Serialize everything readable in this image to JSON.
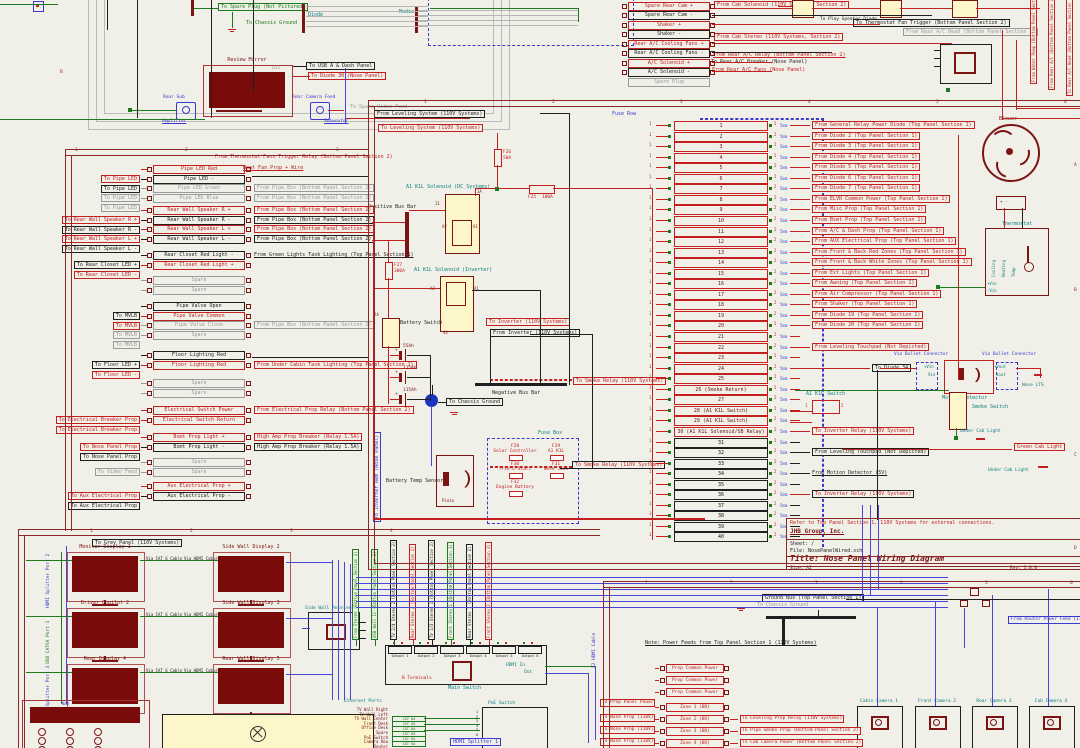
{
  "meta": {
    "title": "Nose Panel Wiring Diagram"
  },
  "colors": {
    "background": "#f0efe8",
    "wire_red": "#c42020",
    "wire_green": "#1d7a1d",
    "wire_blue": "#4646d8",
    "component_dark_red": "#7c1414",
    "component_yellow": "#fdf6c8",
    "teal": "#0e8080",
    "sheet_border": "#8b2727"
  },
  "rulers": {
    "main": [
      "1",
      "2",
      "3",
      "4",
      "5",
      "6"
    ],
    "left": [
      "1",
      "2",
      "3"
    ],
    "bottom_left": [
      "1",
      "2",
      "3",
      "4"
    ],
    "bottom_right": [
      "1",
      "2",
      "3",
      "4",
      "5",
      "6"
    ],
    "letters": [
      "A",
      "B",
      "C",
      "D"
    ]
  },
  "top_left": {
    "spare_plug": "To Spare Plug (Not Pictured)",
    "chassis_ground": "To Chassis Ground",
    "diode": "Diode",
    "media": "Media",
    "conn1_top": "Rear Sub",
    "conn1_bot": "Amplifier",
    "conn2_top": "Rear Camera Feed",
    "conn2_bot": "Subwoofer",
    "monitor_label": "Review Mirror",
    "monitor_ref": "U12",
    "usb_label": "To USB A & Dash Panel",
    "diode30": "To Diode 30 (Nose Panel)",
    "spare_video": "To Spare Video Feed",
    "row_letter": "B"
  },
  "top_pairs": {
    "rows": [
      {
        "a": "Spare Rear Cam +",
        "b": "Spare Rear Cam -"
      },
      {
        "a": "Shaker +",
        "b": "Shaker -"
      },
      {
        "a": "Rear A/C Cooling Fans +",
        "b": "Rear A/C Cooling Fans -"
      },
      {
        "a": "A/C Solenoid +",
        "b": "A/C Solenoid -"
      }
    ],
    "spare": "Spare Plug",
    "lab_play": "To Play Speaker Diode",
    "lab_cab_solenoid": "From Cab Solenoid (110V Systems, Section 2)",
    "lab_cab_stereo": "From Cab Stereo (110V Systems, Section 2)",
    "lab_thermo": "To Thermostat Fan Trigger (Bottom Panel Section 2)",
    "lab_ac_head": "From Rear A/C Head (Bottom Panel Section 2)",
    "lab_ac_relay": "From Rear A/C Relay (Bottom Panel Section 2)",
    "lab_ac_breaker": "To Rear A/C Breaker (Nose Panel)",
    "lab_ac_fans": "From Rear A/C Fans (Nose Panel)",
    "vlabels": [
      "From Water Pump (Bottom Panel Section 2)",
      "From Rear A/C (Bottom Panel Section 2)",
      "To Rear A/C Head (Bottom Panel Section 2)"
    ]
  },
  "left_sheet": {
    "note1": "From Thermostat Fans Trigger Relay (Bottom Panel Section 2)",
    "note2": "Heat Fan Prop + Wire",
    "pin1": "1",
    "pin2": "2",
    "groups": [
      {
        "rows": [
          {
            "l": "To Pipe LED",
            "c": "Pipe LED Red",
            "r": "",
            "cls": "red"
          },
          {
            "l": "To Pipe LED",
            "c": "Pipe LED -",
            "r": "",
            "cls": "black"
          },
          {
            "l": "To Pipe LED",
            "c": "Pipe LED Green",
            "r": "From Pipe Box (Bottom Panel Section 2)",
            "cls": "gray"
          },
          {
            "l": "To Pipe LED",
            "c": "Pipe LED Blue",
            "r": "From Pipe Box (Bottom Panel Section 2)",
            "cls": "gray"
          }
        ]
      },
      {
        "rows": [
          {
            "l": "To Rear Wall Speaker R +",
            "c": "Rear Wall Speaker R +",
            "r": "From Pipe Box (Bottom Panel Section 2)",
            "cls": "red"
          },
          {
            "l": "To Rear Wall Speaker R -",
            "c": "Rear Wall Speaker R -",
            "r": "From Pipe Box (Bottom Panel Section 2)",
            "cls": "black"
          },
          {
            "l": "To Rear Wall Speaker L +",
            "c": "Rear Wall Speaker L +",
            "r": "From Pipe Box (Bottom Panel Section 2)",
            "cls": "red"
          },
          {
            "l": "To Rear Wall Speaker L -",
            "c": "Rear Wall Speaker L -",
            "r": "From Pipe Box (Bottom Panel Section 2)",
            "cls": "black"
          }
        ]
      },
      {
        "rows": [
          {
            "l": "To Rear Closet LED +",
            "c": "Rear Closet Red Light -",
            "r": "From Green Lights Task Lighting (Top Panel Section 1)",
            "cls": "black",
            "rp": true
          },
          {
            "l": "To Rear Closet LED -",
            "c": "Rear Closet Red Light +",
            "r": "",
            "cls": "red"
          }
        ]
      },
      {
        "rows": [
          {
            "l": "",
            "c": "Spare",
            "r": "",
            "cls": "gray"
          },
          {
            "l": "",
            "c": "Spare",
            "r": "",
            "cls": "gray"
          }
        ]
      },
      {
        "rows": [
          {
            "l": "To MVLB",
            "c": "Pipe Valve Open",
            "r": "",
            "cls": "black"
          },
          {
            "l": "To MVLB",
            "c": "Pipe Valve Common",
            "r": "",
            "cls": "red"
          },
          {
            "l": "To MVLB",
            "c": "Pipe Valve Close",
            "r": "From Pipe Box (Bottom Panel Section 2)",
            "cls": "gray"
          },
          {
            "l": "To MVLB",
            "c": "Spare",
            "r": "",
            "cls": "gray"
          }
        ]
      },
      {
        "rows": [
          {
            "l": "To Floor LED +",
            "c": "Floor Lighting Red",
            "r": "",
            "cls": "black"
          },
          {
            "l": "To Floor LED -",
            "c": "Floor Lighting Red",
            "r": "From Under Cabin Task Lighting (Top Panel Section 1)",
            "cls": "red"
          }
        ]
      },
      {
        "rows": [
          {
            "l": "",
            "c": "Spare",
            "r": "",
            "cls": "gray"
          },
          {
            "l": "",
            "c": "Spare",
            "r": "",
            "cls": "gray"
          }
        ]
      },
      {
        "rows": [
          {
            "l": "To Electrical Breaker Prop",
            "c": "Electrical Switch Power",
            "r": "From Electrical Prop Relay (Bottom Panel Section 2)",
            "cls": "red"
          },
          {
            "l": "To Electrical Breaker Prop",
            "c": "Electrical Switch Return",
            "r": "",
            "cls": "red"
          }
        ]
      },
      {
        "rows": [
          {
            "l": "To Nose Panel Prop",
            "c": "Bsmt Prop Light +",
            "r": "High Amp Prop Breaker (Relay 1.5A)",
            "cls": "red"
          },
          {
            "l": "To Nose Panel Prop",
            "c": "Bsmt Prop Light -",
            "r": "High Amp Prop Breaker (Relay 1.5A)",
            "cls": "black"
          }
        ]
      },
      {
        "rows": [
          {
            "l": "To Video Feed",
            "c": "Spare",
            "r": "",
            "cls": "gray"
          },
          {
            "l": "",
            "c": "Spare",
            "r": "",
            "cls": "gray"
          }
        ]
      },
      {
        "rows": [
          {
            "l": "To Aux Electrical Prop",
            "c": "Aux Electrical Prop +",
            "r": "",
            "cls": "red"
          },
          {
            "l": "To Aux Electrical Prop",
            "c": "Aux Electrical Prop -",
            "r": "",
            "cls": "black"
          }
        ]
      }
    ]
  },
  "power": {
    "from_leveling": "From Leveling System (110V Systems)",
    "to_leveling": "To Leveling System (110V Systems)",
    "f26": "F26",
    "f26a": "50A",
    "f25": "F25",
    "f25a": "100A",
    "sol_dc": "A1 K1L Solenoid (DC Systems)",
    "sol_inv": "A1 K1L Solenoid (Inverter)",
    "pos_bus": "Positive Bus Bar",
    "neg_bus": "Negative Bus Bar",
    "f27": "F27",
    "f27a": "300A",
    "bat_switch": "Battery Switch",
    "bats": [
      "55Ah",
      "115Ah",
      "115Ah"
    ],
    "plus": "+",
    "to_chassis": "To Chassis Ground",
    "to_inverter": "To Inverter (110V Systems)",
    "from_inverter": "From Inverter (110V Systems)",
    "fuse_box": "Fuse Box",
    "fuses": [
      {
        "n": "F28",
        "l": "Solar Controller"
      },
      {
        "n": "F29",
        "l": "A1 K1L"
      },
      {
        "n": "F30",
        "l": "Trik-L-Start"
      },
      {
        "n": "F31",
        "l": "Nose Jack"
      },
      {
        "n": "F32",
        "l": "Engine Battery"
      }
    ],
    "bts": "Battery Temp Sensor",
    "piezo": "Piezo",
    "smoke1": "To Smoke Relay (110V Systems)",
    "smoke2": "To Smoke Relay (110V Systems)",
    "inv_rem": "To Inverter Rem (Nose Panel)",
    "p1a": "1A",
    "p11": "11",
    "pa2": "A2",
    "pa1": "A1",
    "p44": "44",
    "p24": "24"
  },
  "fuse_row": {
    "title": "Fuse Row",
    "pin1": "1",
    "pin2": "2",
    "gauge": "5mm",
    "rows": [
      {
        "n": "1",
        "label": "From General Relay Power Diode (Top Panel Section 1)",
        "t": "rb"
      },
      {
        "n": "2",
        "label": "From Diode 2 (Top Panel Section 1)",
        "t": "rb"
      },
      {
        "n": "3",
        "label": "From Diode 3 (Top Panel Section 1)",
        "t": "rb"
      },
      {
        "n": "4",
        "label": "From Diode 4 (Top Panel Section 1)",
        "t": "rb"
      },
      {
        "n": "5",
        "label": "From Diode 5 (Top Panel Section 1)",
        "t": "rb"
      },
      {
        "n": "6",
        "label": "From Diode 6 (Top Panel Section 1)",
        "t": "rb"
      },
      {
        "n": "7",
        "label": "From Diode 7 (Top Panel Section 1)",
        "t": "rb"
      },
      {
        "n": "8",
        "label": "From ELVR Common Power (Top Panel Section 1)",
        "t": "rb"
      },
      {
        "n": "9",
        "label": "From Misc Prop (Top Panel Section 1)",
        "t": "rb"
      },
      {
        "n": "10",
        "label": "From Bsmt Prop (Top Panel Section 1)",
        "t": "rb"
      },
      {
        "n": "11",
        "label": "From A/C & Dash Prop (Top Panel Section 1)",
        "t": "rb"
      },
      {
        "n": "12",
        "label": "From AUX Electrical Prop (Top Panel Section 1)",
        "t": "rb"
      },
      {
        "n": "13",
        "label": "From Front & Back Red Zones (Top Panel Section 1)",
        "t": "rb"
      },
      {
        "n": "14",
        "label": "From Front & Back White Zones (Top Panel Section 1)",
        "t": "rb"
      },
      {
        "n": "15",
        "label": "From Ext Lights (Top Panel Section 1)",
        "t": "rb"
      },
      {
        "n": "16",
        "label": "From Awning (Top Panel Section 1)",
        "t": "rb"
      },
      {
        "n": "17",
        "label": "From Air Compressor (Top Panel Section 1)",
        "t": "rb"
      },
      {
        "n": "18",
        "label": "From Shaker (Top Panel Section 1)",
        "t": "rb"
      },
      {
        "n": "19",
        "label": "From Diode 19 (Top Panel Section 1)",
        "t": "rb"
      },
      {
        "n": "20",
        "label": "From Diode 20 (Top Panel Section 1)",
        "t": "rb"
      },
      {
        "n": "21",
        "label": "",
        "t": ""
      },
      {
        "n": "22",
        "label": "From Leveling Touchpad (Not Depicted)",
        "t": "rb"
      },
      {
        "n": "23",
        "label": "",
        "t": ""
      },
      {
        "n": "24",
        "label": "To Diode 34",
        "t": "d34"
      },
      {
        "n": "25",
        "label": "",
        "t": ""
      },
      {
        "n": "26 (Smoke Return)",
        "label": "",
        "t": ""
      },
      {
        "n": "27",
        "label": "",
        "t": ""
      },
      {
        "n": "28 (A1 K1L Switch)",
        "label": "",
        "t": ""
      },
      {
        "n": "29 (A1 K1L Switch)",
        "label": "",
        "t": ""
      },
      {
        "n": "30 (A1 K1L Solenoid/SB Relay)",
        "label": "To Inverter Relay (110V Systems)",
        "t": "rb"
      },
      {
        "n": "31",
        "label": "",
        "t": ""
      },
      {
        "n": "32",
        "label": "From Leveling Touchpad (Not Depicted)",
        "t": "kb"
      },
      {
        "n": "33",
        "label": "",
        "t": ""
      },
      {
        "n": "34",
        "label": "From Motion Detector (5V)",
        "t": "kt"
      },
      {
        "n": "35",
        "label": "",
        "t": ""
      },
      {
        "n": "36",
        "label": "To Inverter Relay (110V Systems)",
        "t": "rk"
      },
      {
        "n": "37",
        "label": "",
        "t": ""
      },
      {
        "n": "38",
        "label": "",
        "t": ""
      },
      {
        "n": "39",
        "label": "",
        "t": ""
      },
      {
        "n": "40",
        "label": "",
        "t": ""
      }
    ]
  },
  "right_side": {
    "blower": "Blower",
    "blower_pins": "+   -",
    "thermostat": "Thermostat",
    "t_cool": "Cooling",
    "t_heat": "Heating",
    "t_temp": "Temp",
    "t_vin1": "+Vin",
    "t_vin2": "-Vin",
    "bullet1": "Via Bullet Connector",
    "bullet2": "Via Bullet Connector",
    "motion": "Motion Detector",
    "m_vin1": "+Vin",
    "m_vin2": "Vin",
    "m_vout1": "+Vout",
    "m_vout2": "Vout",
    "nose_lts": "Nose LTS",
    "smoke_switch": "Smoke Switch",
    "a1k1l": "A1 K1L Switch",
    "sw_p1": "1",
    "sw_p2": "2",
    "under1": "Under Cab Light",
    "under2": "Under Cab Light",
    "green_cab": "Green Cab Light"
  },
  "title_block": {
    "note": "Refer to Top Panel Section 1, 110V Systems for external connections.",
    "company": "JHB Group, Inc.",
    "sheet": "Sheet: /",
    "file": "File: NosePanelWired.sch",
    "title": "Title: Nose Panel Wiring Diagram",
    "size": "Size: A2",
    "rev": "Rev: 1.0.0"
  },
  "grey_panel": {
    "header": "To Grey Panel (110V Systems)",
    "monitors": [
      "Monitor Display 1",
      "Side Wall Display 2",
      "Driver Copilot 2",
      "Side Wall Display 3",
      "Rear Display 4",
      "Rear Wall Display 5"
    ],
    "via1": "Via CAT 6 Cable",
    "via2": "Via HDMI Cable",
    "side_labels": [
      {
        "t": "HDMI Splitter Port 2",
        "c": "b"
      },
      {
        "t": "USB CAT6A Port 1",
        "c": "g"
      },
      {
        "t": "HDMI Splitter Port 3",
        "c": "b"
      }
    ],
    "receiver": "Side Wall Receiver",
    "touchpad": "Nav"
  },
  "av": {
    "vlabels": [
      {
        "t": "From Stereo (Bottom Panel Section 2)",
        "c": "g"
      },
      {
        "t": "USB Wall In (Bottom Panel Section 2)",
        "c": "g"
      },
      {
        "t": "TV 2/4 Stereo 2 (Bottom Panel Section 2)",
        "c": "k"
      },
      {
        "t": "Rear Stereo 2 (Bottom Panel Section 2)",
        "c": "r"
      },
      {
        "t": "TV 1/3 Stereo 1 (Bottom Panel Section 2)",
        "c": "k"
      },
      {
        "t": "Front Stereo 1 (Bottom Panel Section 2)",
        "c": "g"
      },
      {
        "t": "Rear Stereo 1 (Bottom Panel Section 2)",
        "c": "k"
      },
      {
        "t": "Front Stereo 2 (Bottom Panel Section 2)",
        "c": "r"
      }
    ],
    "main_switch": "Main Switch",
    "outputs": [
      "Output 1",
      "Output 2",
      "Output 3",
      "Output 4",
      "Output 5",
      "Output 6"
    ],
    "b_terminals": "B Terminals",
    "hdmi_in": "HDMI In",
    "out": "Out",
    "x2hdmi": "X2 HDMI Cable",
    "eth": "Ethernet Ports",
    "ports": [
      "TV Wall Right",
      "TV Wall Left",
      "TV Wall Center",
      "Front Desk",
      "Office Desk",
      "Spare",
      "PoE Switch",
      "Camera Row",
      "Router"
    ],
    "cables": [
      "CAT 6A",
      "CAT 6A",
      "CAT 6A",
      "CAT 6A",
      "CAT 6A",
      "CAT 6A"
    ],
    "poe": "PoE Switch",
    "poe_pins": [
      "1",
      "2",
      "3",
      "4",
      "5",
      "6",
      "7",
      "8"
    ],
    "hdmi_splitter": "HDMI Splitter 1"
  },
  "ground_sheet": {
    "ground_label": "Ground Bus (Top Panel Section 1)",
    "to_chassis": "To Chassis Ground",
    "note": "Note: Power Feeds from Top Panel Section 1 (110V Systems)",
    "router_feed": "From Router Power Feed (110V Systems)",
    "cameras": [
      "Cabin Camera 1",
      "Front Camera 2",
      "Rear Camera 3",
      "Cab Camera 4"
    ],
    "rows": [
      {
        "l": "",
        "c": "Prop Common Power",
        "r": ""
      },
      {
        "l": "",
        "c": "Prop Common Power",
        "r": ""
      },
      {
        "l": "To Prop Panel Power",
        "c": "Prop Common Power",
        "r": ""
      },
      {
        "l": "To Nose Prop (110V)",
        "c": "Zone 1 (BR)",
        "r": ""
      },
      {
        "l": "To Nose Prop (110V)",
        "c": "Zone 2 (BR)",
        "r": "To Leveling Prop Relay (110V Systems)"
      },
      {
        "l": "To Nose Prop (110V)",
        "c": "Zone 3 (BR)",
        "r": "To Pipe Smoke Prop (Bottom Panel Section 2)"
      },
      {
        "l": "To Nose Prop (110V)",
        "c": "Zone 4 (BR)",
        "r": "To Cab Camera Power (Bottom Panel Section 2)"
      }
    ]
  }
}
